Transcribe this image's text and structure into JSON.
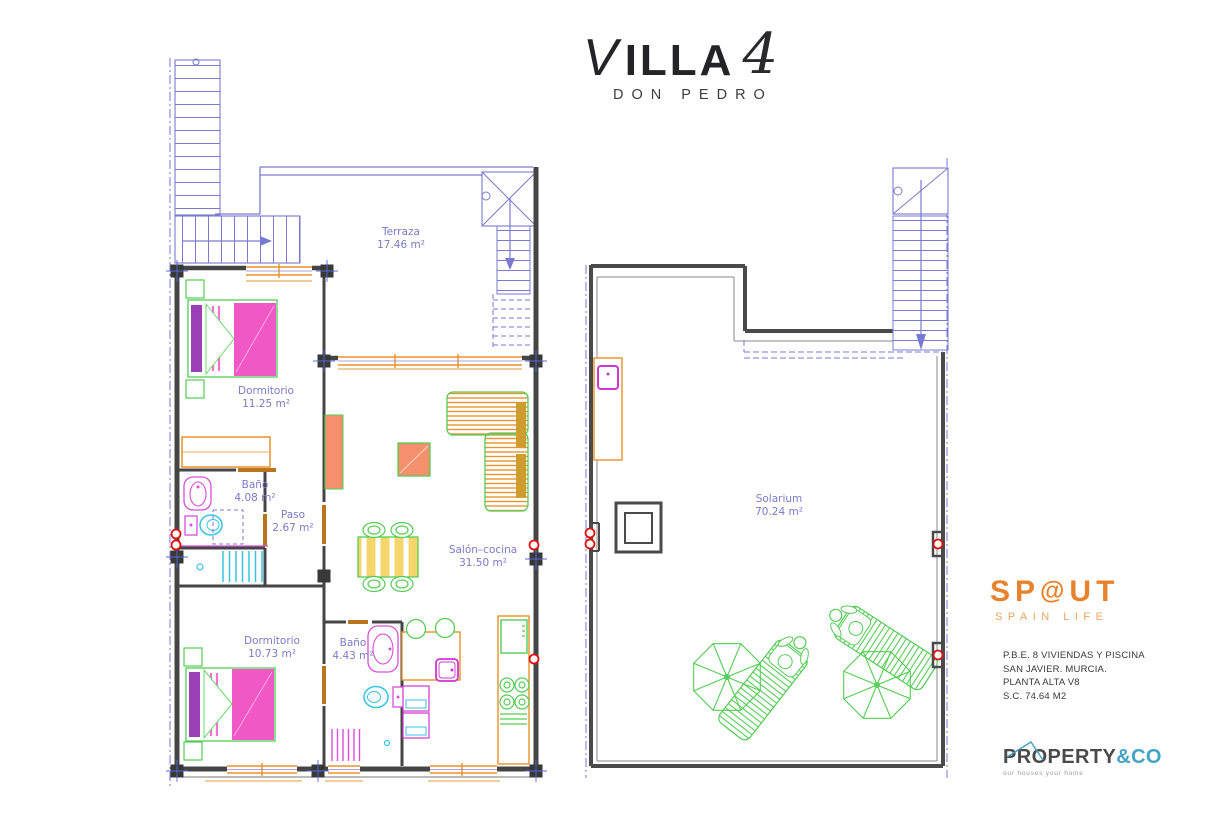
{
  "header": {
    "title": "VILLA",
    "title_number": "4",
    "subtitle": "DON PEDRO"
  },
  "plans": {
    "left": {
      "rooms": [
        {
          "name": "Terraza",
          "area": "17.46 m²"
        },
        {
          "name": "Dormitorio",
          "area": "11.25 m²"
        },
        {
          "name": "Baño",
          "area": "4.08 m²"
        },
        {
          "name": "Paso",
          "area": "2.67 m²"
        },
        {
          "name": "Salón–cocina",
          "area": "31.50 m²"
        },
        {
          "name": "Dormitorio",
          "area": "10.73 m²"
        },
        {
          "name": "Baño",
          "area": "4.43 m²"
        }
      ]
    },
    "right": {
      "rooms": [
        {
          "name": "Solarium",
          "area": "70.24 m²"
        }
      ]
    }
  },
  "branding": {
    "agency": {
      "name_left": "SP",
      "name_swirl": "@",
      "name_right": "UT",
      "tagline": "SPAIN LIFE",
      "color": "#e8832d"
    },
    "project": {
      "lines": [
        "P.B.E. 8 VIVIENDAS Y PISCINA",
        "SAN JAVIER. MURCIA.",
        "PLANTA ALTA V8",
        "S.C. 74.64 M2"
      ]
    },
    "realtor": {
      "name": "PROPERTY",
      "suffix": "&CO",
      "tagline": "our houses your home",
      "accent_color": "#44a3c4"
    }
  },
  "colors": {
    "walls": "#454545",
    "stairs_blue": "#7a7ad0",
    "labels_blue": "#7b7bc8",
    "window_orange": "#e8922c",
    "furniture_green": "#55cc55",
    "furniture_salmon": "#f4916c",
    "bed_pink": "#ef58c5",
    "pillow_purple": "#9a3fb5",
    "fixture_magenta": "#d94fd9",
    "fixture_cyan": "#35c4e4",
    "table_yellow": "#f5d66b",
    "marker_red": "#dd1111"
  }
}
